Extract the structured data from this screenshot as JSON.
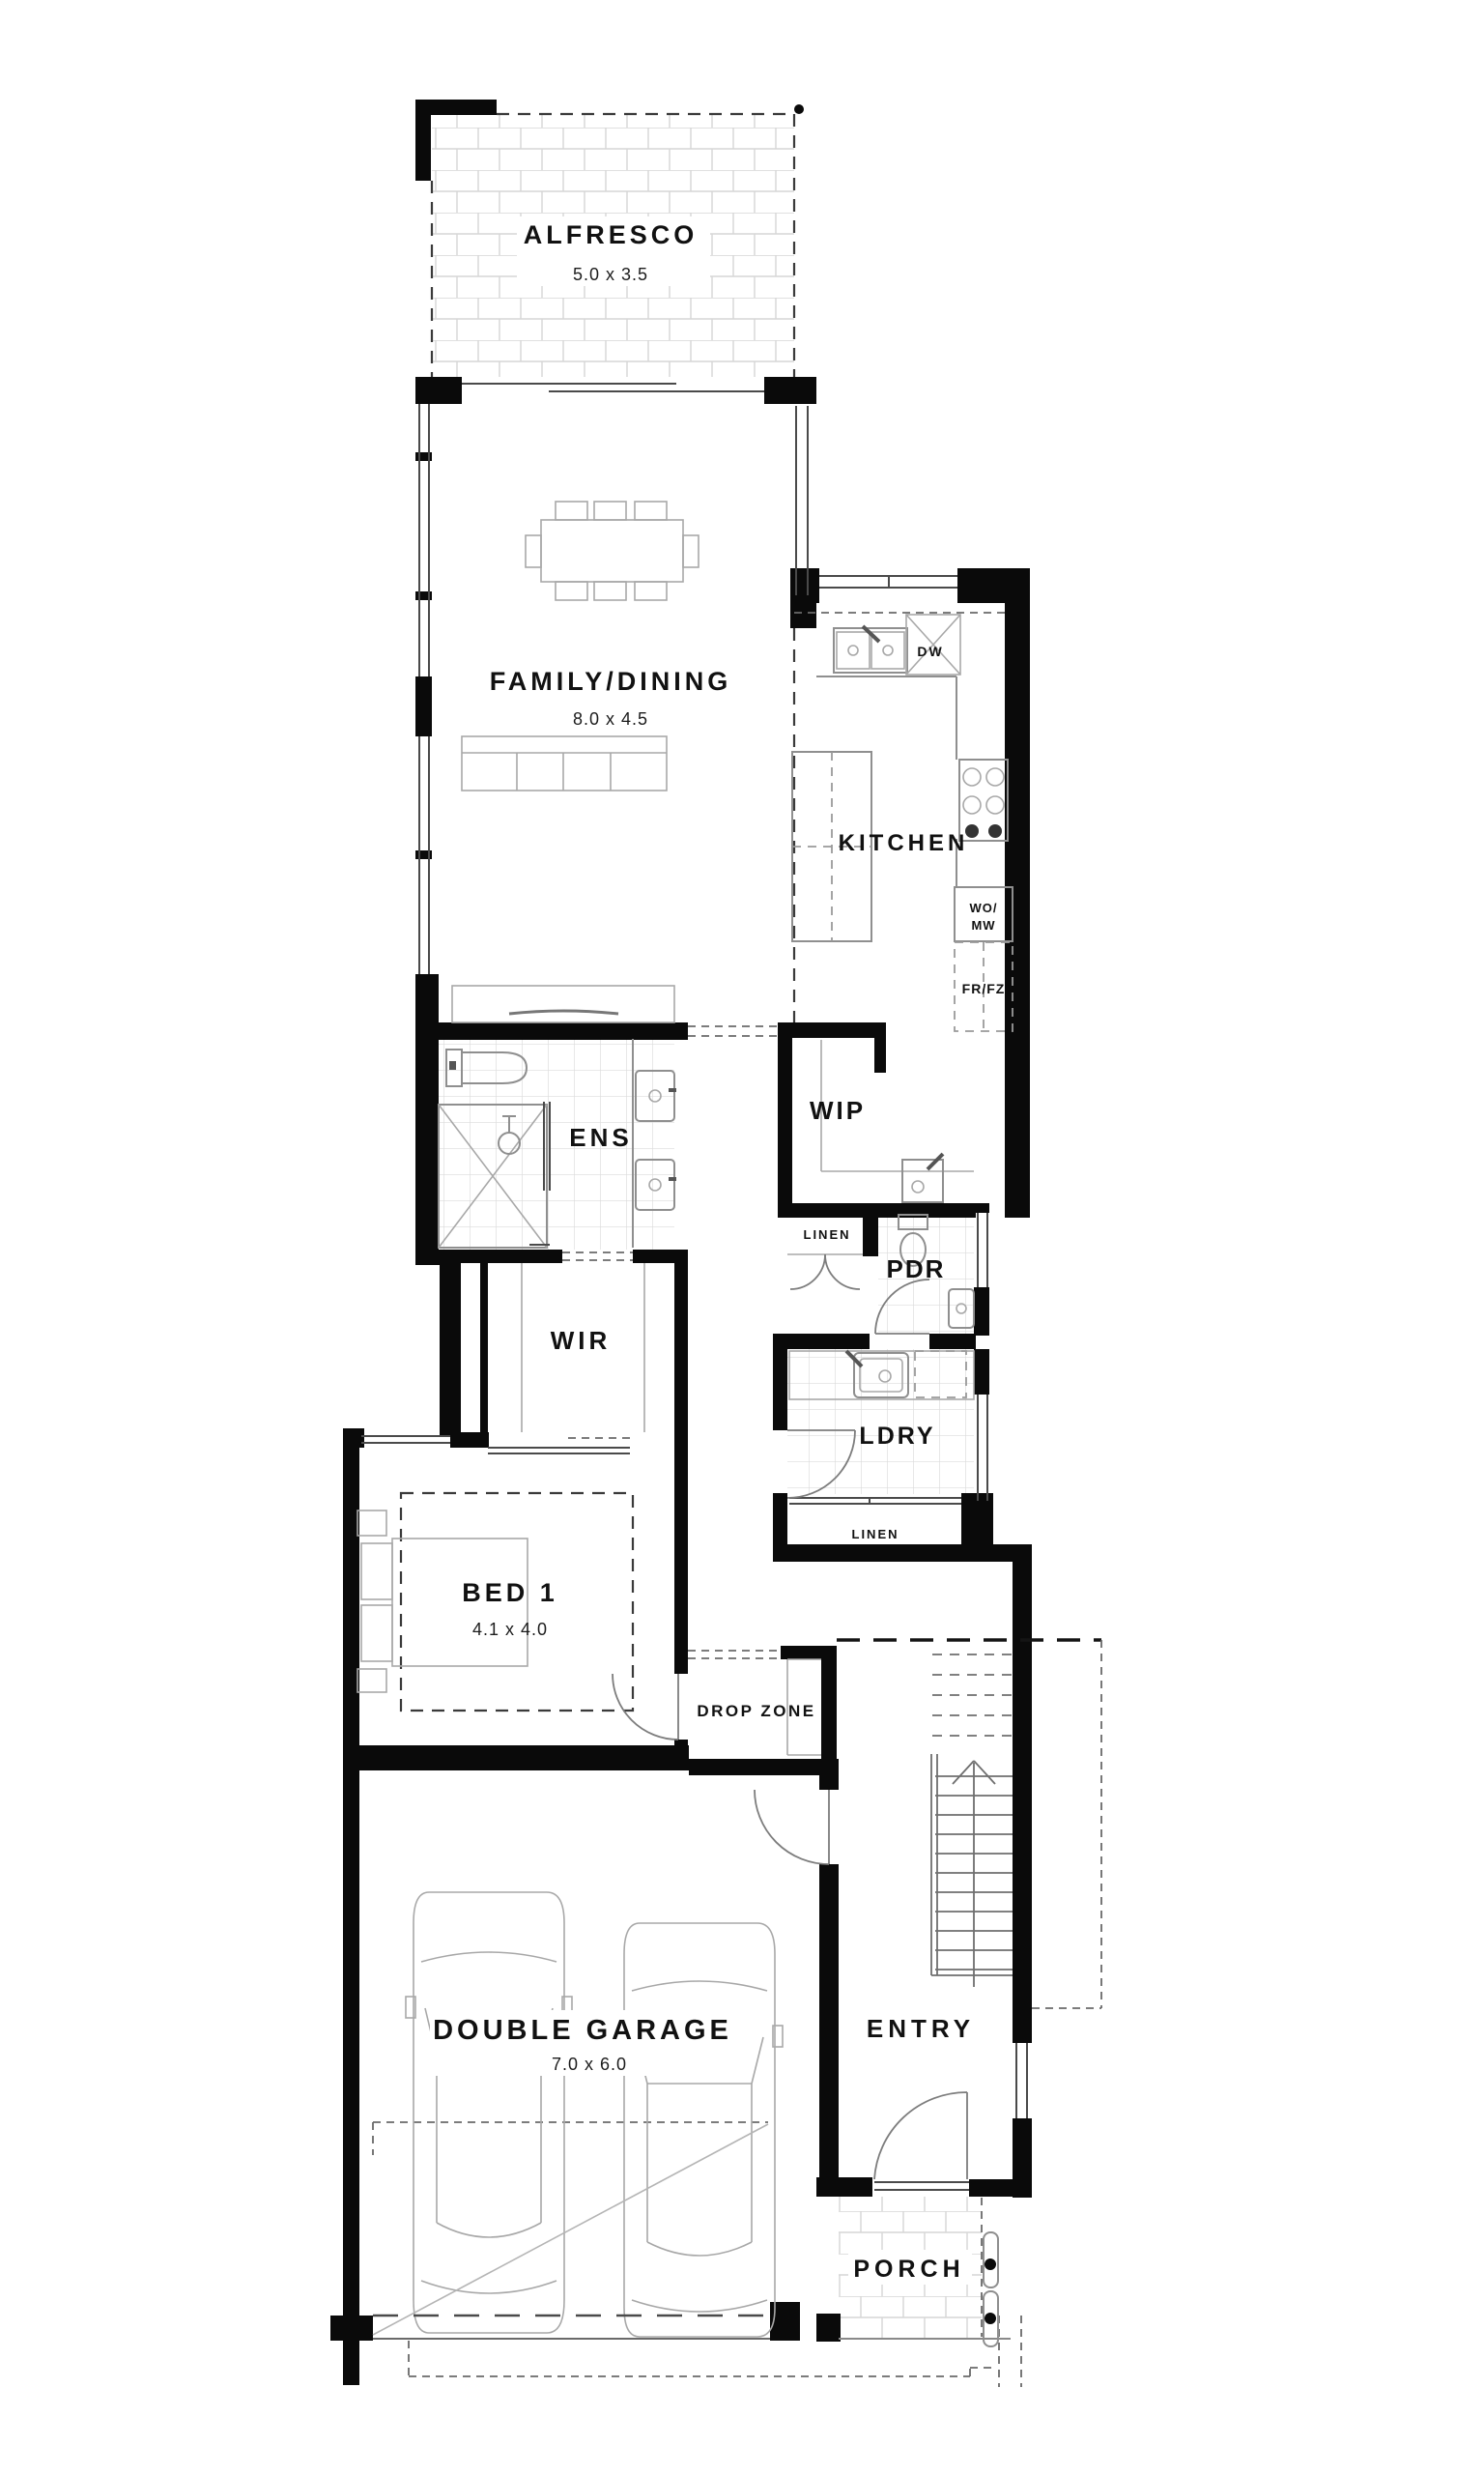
{
  "plan": {
    "rooms": {
      "alfresco": {
        "label": "ALFRESCO",
        "dim": "5.0 x 3.5"
      },
      "family_dining": {
        "label": "FAMILY/DINING",
        "dim": "8.0 x 4.5"
      },
      "kitchen": {
        "label": "KITCHEN"
      },
      "wip": {
        "label": "WIP"
      },
      "ens": {
        "label": "ENS"
      },
      "wir": {
        "label": "WIR"
      },
      "linen_hall": {
        "label": "LINEN"
      },
      "pdr": {
        "label": "PDR"
      },
      "ldry": {
        "label": "LDRY"
      },
      "linen_ldry": {
        "label": "LINEN"
      },
      "bed1": {
        "label": "BED 1",
        "dim": "4.1 x 4.0"
      },
      "drop_zone": {
        "label": "DROP ZONE"
      },
      "garage": {
        "label": "DOUBLE GARAGE",
        "dim": "7.0 x 6.0"
      },
      "entry": {
        "label": "ENTRY"
      },
      "porch": {
        "label": "PORCH"
      }
    },
    "appliances": {
      "dishwasher": "DW",
      "wall_oven_microwave_line1": "WO/",
      "wall_oven_microwave_line2": "MW",
      "fridge_freezer": "FR/FZ"
    },
    "colors": {
      "wall": "#0a0a0a",
      "paper": "#ffffff",
      "fixture_line": "#8f8f8f",
      "tile_line": "#dcdcdc",
      "text": "#111111"
    }
  }
}
